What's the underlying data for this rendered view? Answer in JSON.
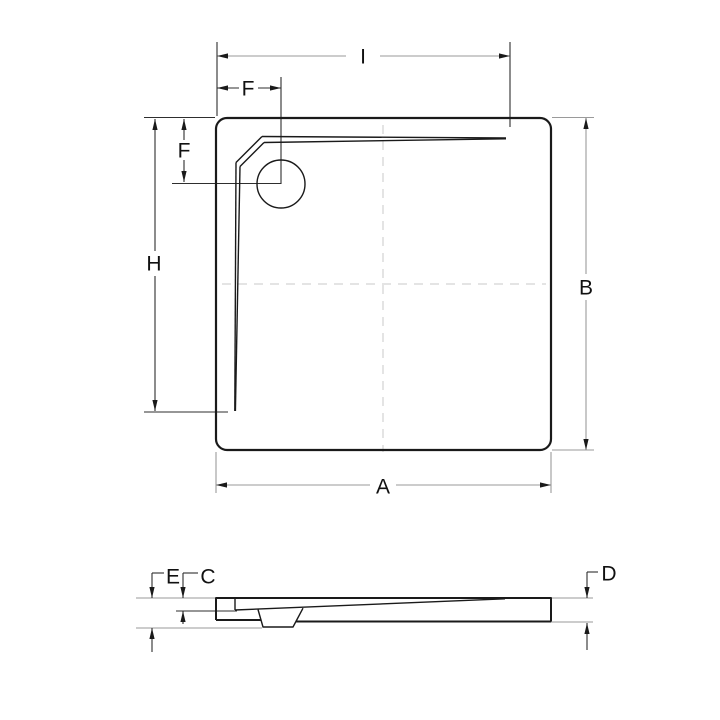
{
  "colors": {
    "object_line": "#1a1a1a",
    "dimension_line_dark": "#2e2e2e",
    "dimension_line_light": "#9a9a9a",
    "centerline": "#c9c9c9",
    "arrow": "#1a1a1a",
    "label_text": "#111111",
    "background": "#ffffff"
  },
  "top_view": {
    "labels": {
      "groove_length_top": "I",
      "drain_offset_horizontal": "F",
      "drain_offset_vertical": "F",
      "groove_height_left": "H",
      "overall_height_right": "B",
      "overall_width_bottom": "A"
    }
  },
  "side_view": {
    "labels": {
      "overall_depth": "E",
      "rim_depth": "C",
      "edge_height": "D"
    }
  }
}
